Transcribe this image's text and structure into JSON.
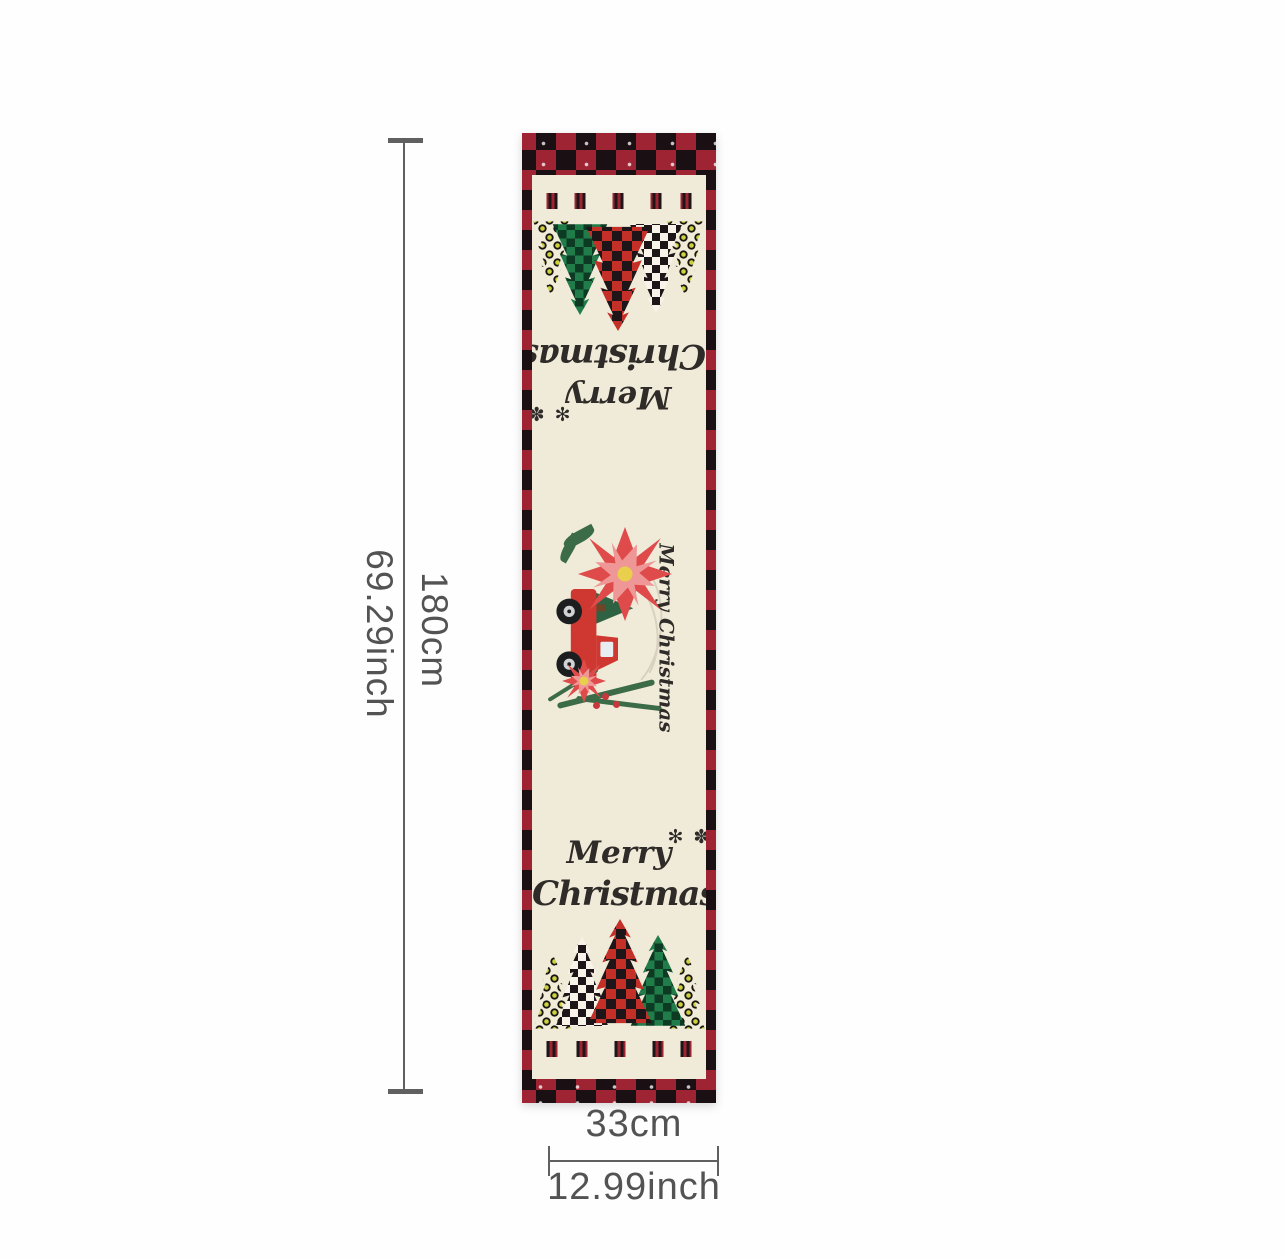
{
  "dimensions": {
    "height_cm": "180cm",
    "height_inch": "69.29inch",
    "width_cm": "33cm",
    "width_inch": "12.99inch"
  },
  "runner": {
    "script_line1": "Merry",
    "script_line2": "Christmas",
    "middle_script": "Merry Christmas",
    "snowflakes": "✻ ✽"
  },
  "colors": {
    "dim_line": "#606060",
    "dim_text": "#535353",
    "plaid_red": "#9e2433",
    "plaid_black": "#1a0f12",
    "cream": "#f0ead8",
    "check_black": "#1d1517",
    "tree_red": "#c43028",
    "tree_green": "#207d49",
    "tree_green_dark": "#0c3a22",
    "tree_white": "#f7f3e8",
    "leopard_base": "#f1ecd8",
    "leopard_spot": "#ccd13d",
    "ink": "#2e2b28",
    "truck_red": "#ce3831",
    "truck_dark": "#a8231f",
    "window": "#e7edf0",
    "wheel": "#1b1d1e",
    "hub": "#d0d3d5",
    "poinsettia_red": "#df4b4b",
    "poinsettia_pink": "#ef9696",
    "flower_center": "#e9cf4b",
    "greenery": "#3c6b47",
    "berry": "#c8373c",
    "feather": "#d8d1c0"
  }
}
